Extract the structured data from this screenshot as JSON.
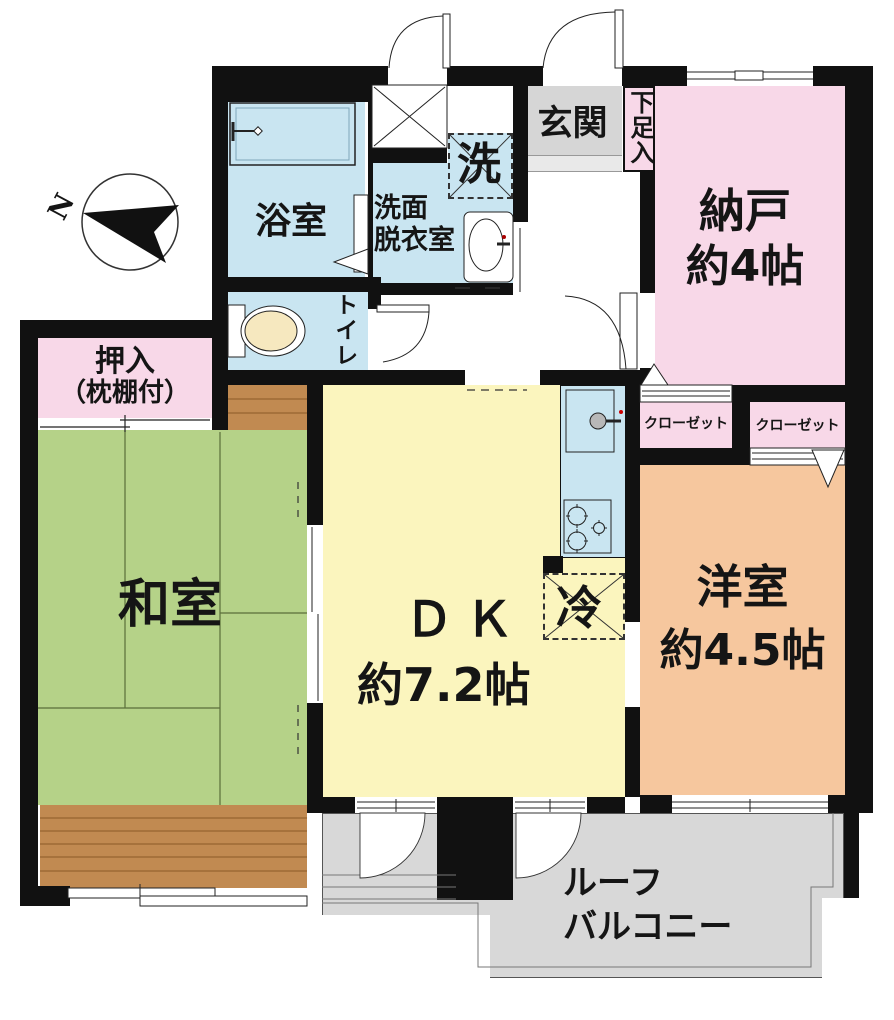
{
  "compass": {
    "north_label": "N"
  },
  "rooms": {
    "bathroom": {
      "label": "浴室"
    },
    "washroom": {
      "line1": "洗面",
      "line2": "脱衣室"
    },
    "washer_space": {
      "label": "洗"
    },
    "entrance": {
      "label": "玄関"
    },
    "shoe_cabinet": {
      "label": "下足入"
    },
    "storage_room": {
      "label": "納戸",
      "size": "約4帖"
    },
    "toilet": {
      "label": "トイレ"
    },
    "futon_closet": {
      "line1": "押入",
      "line2": "（枕棚付）"
    },
    "japanese_room": {
      "label": "和室"
    },
    "dining_kitchen": {
      "label": "ＤＫ",
      "size": "約7.2帖"
    },
    "refrigerator": {
      "label": "冷"
    },
    "closet_left": {
      "label": "クローゼット"
    },
    "closet_right": {
      "label": "クローゼット"
    },
    "western_room": {
      "label": "洋室",
      "size": "約4.5帖"
    },
    "roof_balcony": {
      "line1": "ルーフ",
      "line2": "バルコニー"
    }
  },
  "colors": {
    "pink": "#F8D8E8",
    "blue": "#C9E5F1",
    "green": "#B5D288",
    "yellow": "#FBF5BE",
    "salmon": "#F6C79E",
    "wood": "#C18A51",
    "gray_entry": "#D6D6D6",
    "gray_step": "#E9E9E9",
    "gray_balcony": "#D8D8D8",
    "cream": "#F6E8BF",
    "wall": "#111111"
  }
}
